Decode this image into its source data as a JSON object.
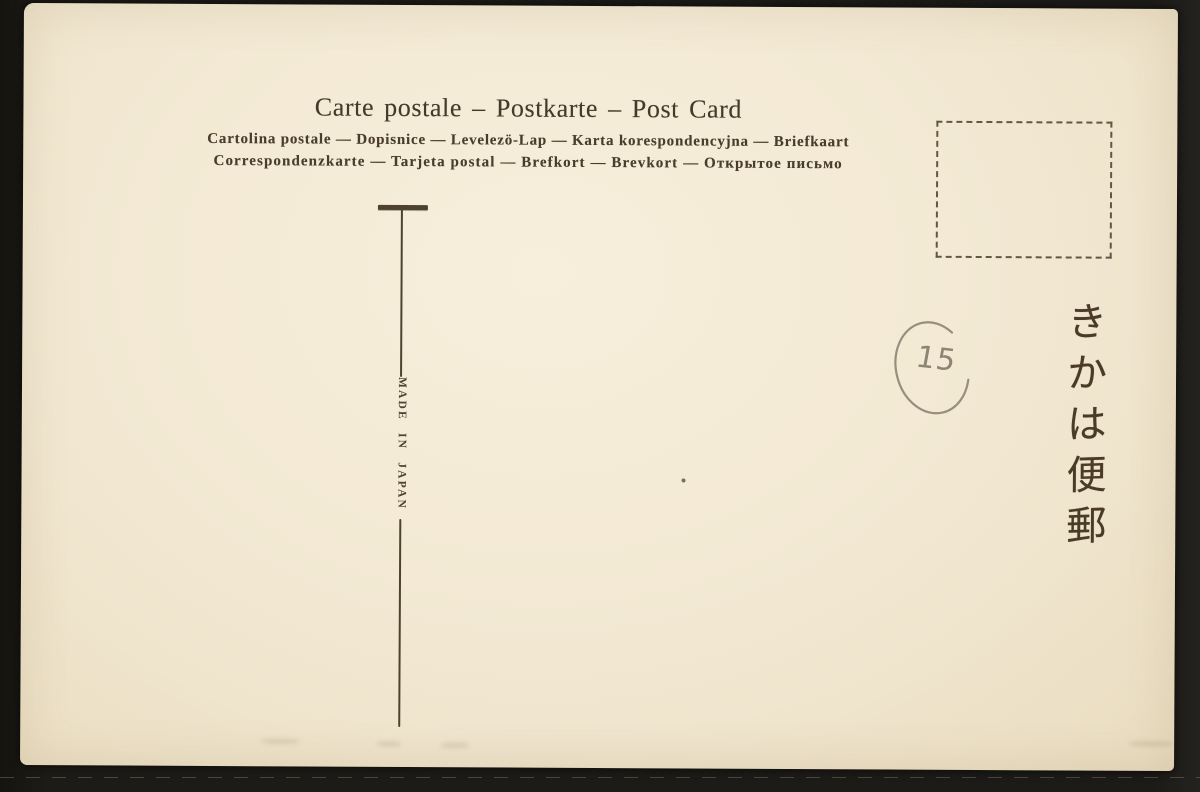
{
  "card": {
    "heading": "Carte postale – Postkarte – Post Card",
    "languages_line1": "Cartolina postale — Dopisnice — Levelezö-Lap — Karta korespondencyjna — Briefkaart",
    "languages_line2": "Correspondenzkarte — Tarjeta postal — Brefkort — Brevkort — Открытое письмо",
    "made_in": "MADE IN JAPAN",
    "japanese_vertical": "きかは便郵",
    "pencil_number": "15"
  },
  "colors": {
    "ink": "#4a3c2c",
    "divider": "#4e4130",
    "pencil": "#8d8474",
    "paper": "#f2e8d2",
    "scan_background": "#1c1b17"
  }
}
